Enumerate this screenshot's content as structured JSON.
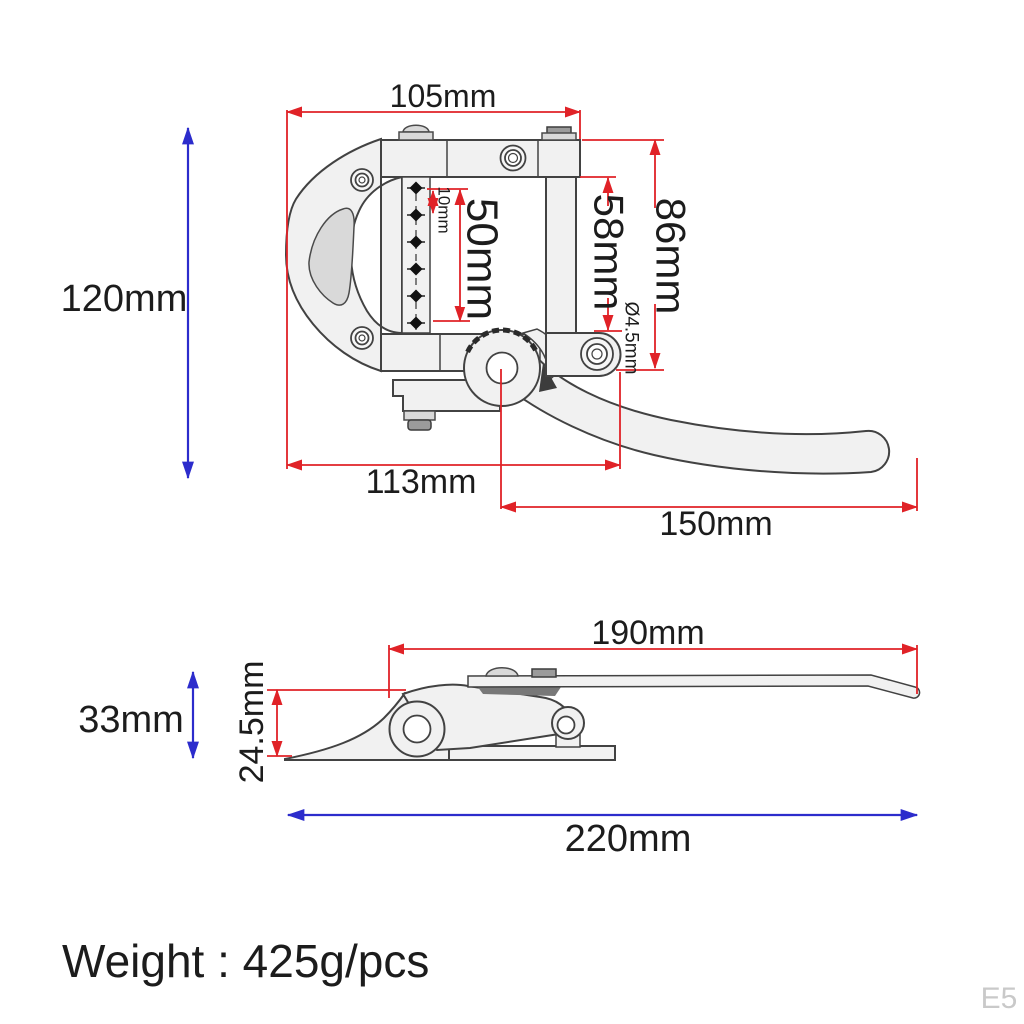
{
  "colors": {
    "dimension_red": "#e02227",
    "dimension_blue": "#2c2ccc",
    "part_fill": "#f1f1f1",
    "part_fill_dark": "#d9d9d9",
    "outline": "#424242",
    "text": "#1c1c1c",
    "watermark_gray": "#c9c9c9"
  },
  "top_view": {
    "pin_count": 6,
    "dims": {
      "top_width": "105mm",
      "overall_height": "120mm",
      "pin_pitch": "10mm",
      "pin_span": "50mm",
      "inner_height": "58mm",
      "frame_height": "86mm",
      "hole_diameter": "Ø4.5mm",
      "base_width": "113mm",
      "arm_length": "150mm"
    }
  },
  "side_view": {
    "dims": {
      "arm_length": "190mm",
      "overall_height": "33mm",
      "body_height": "24.5mm",
      "overall_length": "220mm"
    }
  },
  "footer": {
    "weight_label": "Weight : 425g/pcs"
  },
  "watermark": "E5"
}
